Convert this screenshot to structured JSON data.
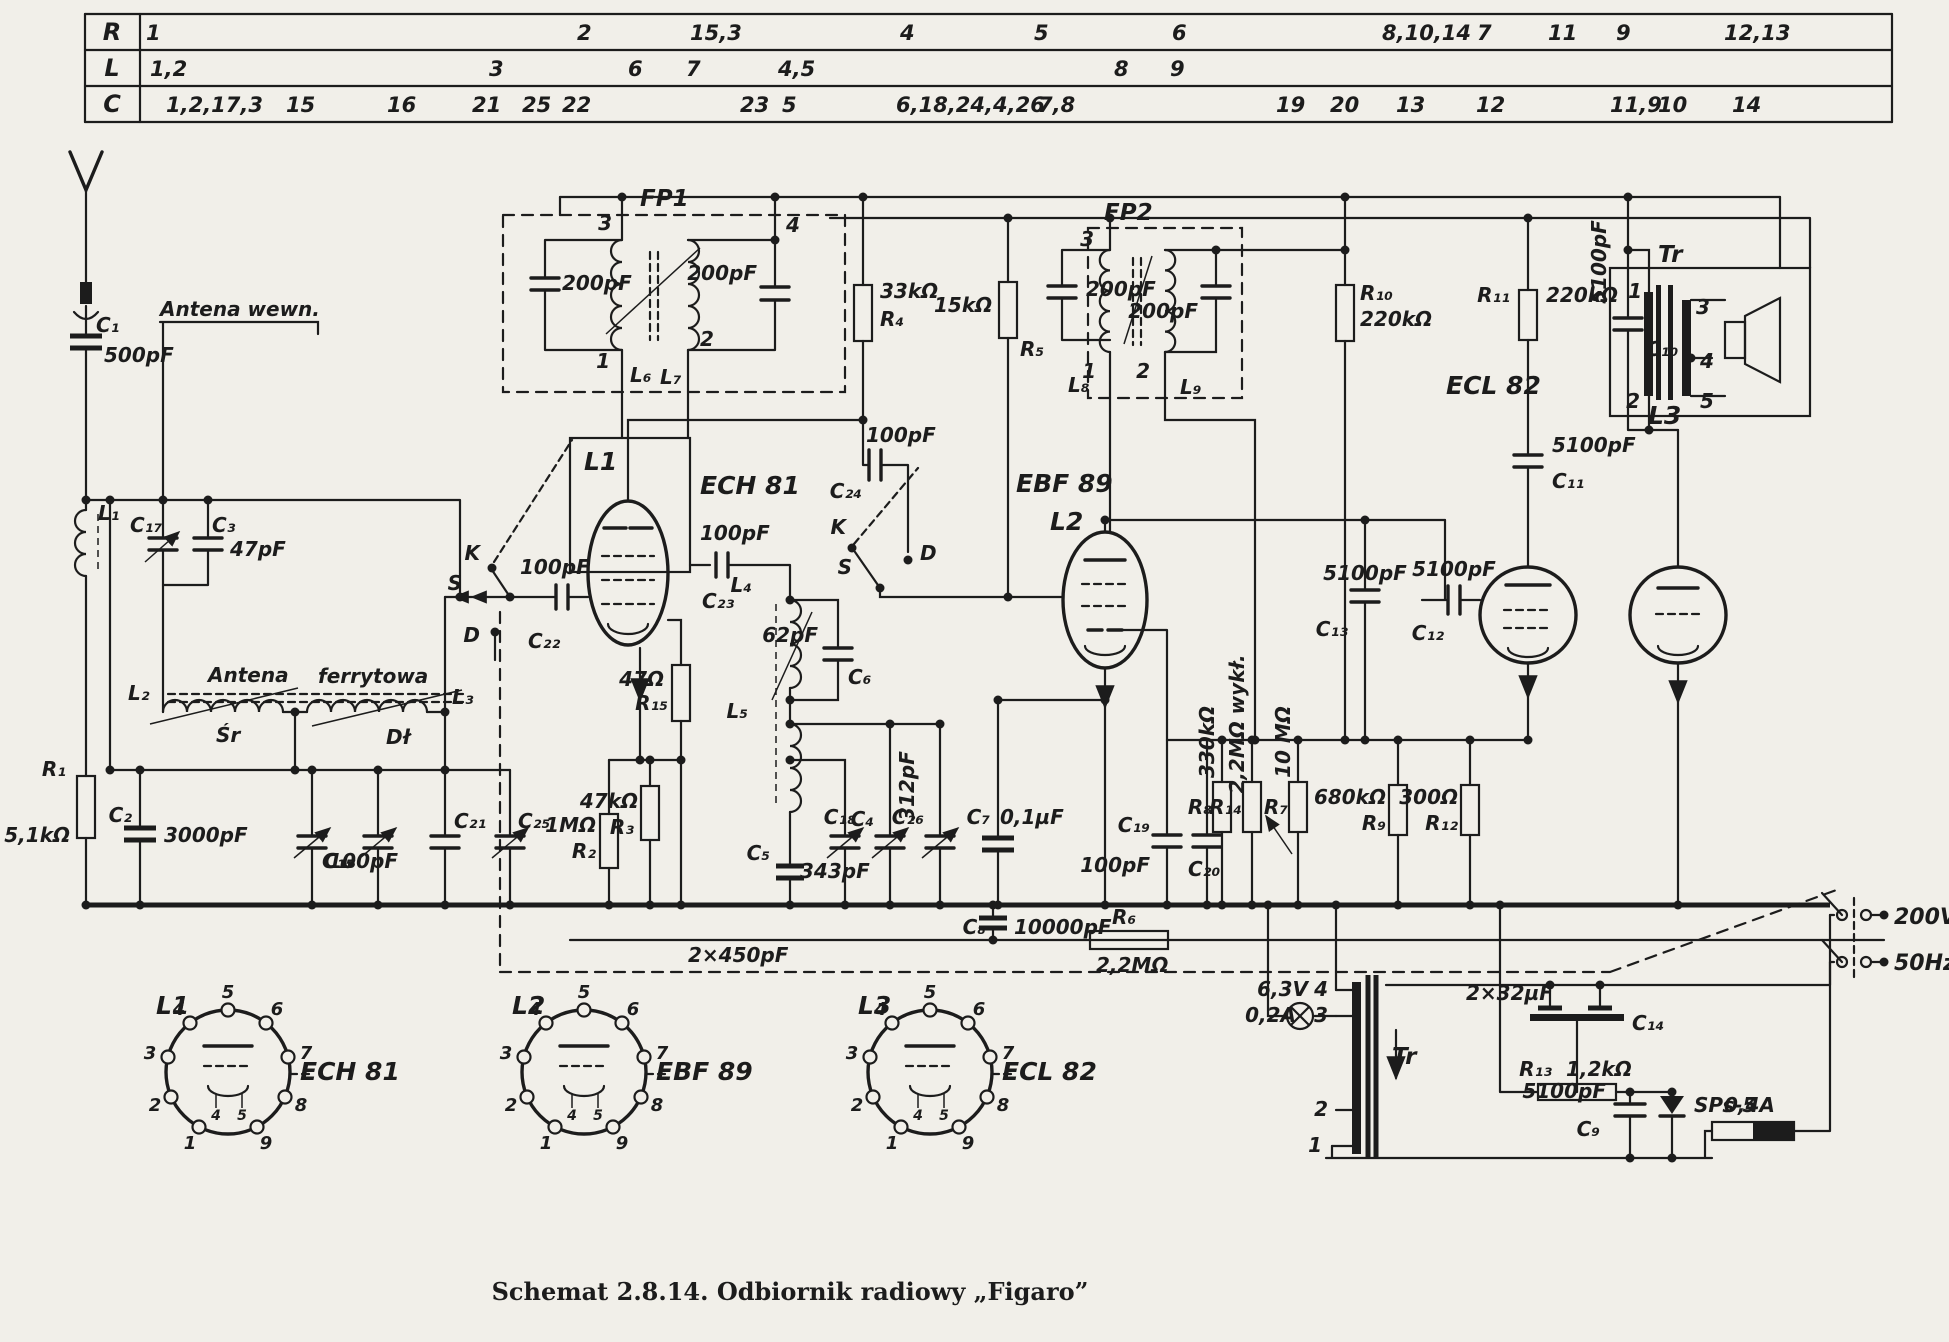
{
  "caption": "Schemat 2.8.14. Odbiornik radiowy „Figaro”",
  "colors": {
    "paper": "#f1efe9",
    "ink": "#1c1c1c"
  },
  "table": {
    "header_x": 112,
    "rows": [
      {
        "header": "R",
        "y": 40,
        "cells": [
          {
            "t": "1",
            "x": 146
          },
          {
            "t": "2",
            "x": 577
          },
          {
            "t": "15,3",
            "x": 690
          },
          {
            "t": "4",
            "x": 900
          },
          {
            "t": "5",
            "x": 1034
          },
          {
            "t": "6",
            "x": 1172
          },
          {
            "t": "8,10,14",
            "x": 1382
          },
          {
            "t": "7",
            "x": 1477
          },
          {
            "t": "11",
            "x": 1548
          },
          {
            "t": "9",
            "x": 1616
          },
          {
            "t": "12,13",
            "x": 1724
          }
        ]
      },
      {
        "header": "L",
        "y": 76,
        "cells": [
          {
            "t": "1,2",
            "x": 150
          },
          {
            "t": "3",
            "x": 489
          },
          {
            "t": "6",
            "x": 628
          },
          {
            "t": "7",
            "x": 686
          },
          {
            "t": "4,5",
            "x": 778
          },
          {
            "t": "8",
            "x": 1114
          },
          {
            "t": "9",
            "x": 1170
          }
        ]
      },
      {
        "header": "C",
        "y": 112,
        "cells": [
          {
            "t": "1,2,17,3",
            "x": 166
          },
          {
            "t": "15",
            "x": 286
          },
          {
            "t": "16",
            "x": 387
          },
          {
            "t": "21",
            "x": 472
          },
          {
            "t": "25",
            "x": 522
          },
          {
            "t": "22",
            "x": 562
          },
          {
            "t": "23",
            "x": 740
          },
          {
            "t": "5",
            "x": 782
          },
          {
            "t": "6,18,24,4,26",
            "x": 896
          },
          {
            "t": "7,8",
            "x": 1038
          },
          {
            "t": "19",
            "x": 1276
          },
          {
            "t": "20",
            "x": 1330
          },
          {
            "t": "13",
            "x": 1396
          },
          {
            "t": "12",
            "x": 1476
          },
          {
            "t": "11,9",
            "x": 1610
          },
          {
            "t": "10",
            "x": 1658
          },
          {
            "t": "14",
            "x": 1732
          }
        ]
      }
    ]
  },
  "schematic_labels": [
    {
      "t": "C₁",
      "x": 96,
      "y": 332
    },
    {
      "t": "500pF",
      "x": 104,
      "y": 362
    },
    {
      "t": "Antena wewn.",
      "x": 160,
      "y": 316
    },
    {
      "t": "L₁",
      "x": 98,
      "y": 520
    },
    {
      "t": "C₁₇",
      "x": 130,
      "y": 532
    },
    {
      "t": "C₃",
      "x": 212,
      "y": 532
    },
    {
      "t": "47pF",
      "x": 230,
      "y": 556
    },
    {
      "t": "L₂",
      "x": 128,
      "y": 700
    },
    {
      "t": "Antena",
      "x": 208,
      "y": 682
    },
    {
      "t": "ferrytowa",
      "x": 318,
      "y": 683
    },
    {
      "t": "Śr",
      "x": 216,
      "y": 742
    },
    {
      "t": "Dł",
      "x": 386,
      "y": 744
    },
    {
      "t": "L₃",
      "x": 452,
      "y": 704
    },
    {
      "t": "R₁",
      "x": 66,
      "y": 776,
      "a": "end"
    },
    {
      "t": "5,1kΩ",
      "x": 70,
      "y": 842,
      "a": "end"
    },
    {
      "t": "C₂",
      "x": 132,
      "y": 822,
      "a": "end"
    },
    {
      "t": "3000pF",
      "x": 164,
      "y": 842
    },
    {
      "t": "C₁₅",
      "x": 322,
      "y": 868
    },
    {
      "t": "C₁₆",
      "x": 356,
      "y": 868,
      "a": "end"
    },
    {
      "t": "C₂₁",
      "x": 454,
      "y": 828
    },
    {
      "t": "100pF",
      "x": 398,
      "y": 868,
      "a": "end"
    },
    {
      "t": "C₂₅",
      "x": 518,
      "y": 828
    },
    {
      "t": "K",
      "x": 480,
      "y": 560,
      "a": "end"
    },
    {
      "t": "S",
      "x": 462,
      "y": 590,
      "a": "end"
    },
    {
      "t": "D",
      "x": 480,
      "y": 642,
      "a": "end"
    },
    {
      "t": "100pF",
      "x": 520,
      "y": 574
    },
    {
      "t": "C₂₂",
      "x": 528,
      "y": 648
    },
    {
      "t": "FP1",
      "x": 640,
      "y": 206,
      "fs": 23
    },
    {
      "t": "3",
      "x": 612,
      "y": 230,
      "a": "end"
    },
    {
      "t": "200pF",
      "x": 562,
      "y": 290
    },
    {
      "t": "1",
      "x": 610,
      "y": 368,
      "a": "end"
    },
    {
      "t": "L₆",
      "x": 630,
      "y": 382
    },
    {
      "t": "4",
      "x": 786,
      "y": 232
    },
    {
      "t": "2",
      "x": 700,
      "y": 346
    },
    {
      "t": "L₇",
      "x": 660,
      "y": 384
    },
    {
      "t": "200pF",
      "x": 757,
      "y": 280,
      "a": "end"
    },
    {
      "t": "L1",
      "x": 584,
      "y": 470,
      "fs": 25
    },
    {
      "t": "ECH 81",
      "x": 700,
      "y": 494,
      "fs": 25
    },
    {
      "t": "100pF",
      "x": 700,
      "y": 540
    },
    {
      "t": "C₂₃",
      "x": 702,
      "y": 608
    },
    {
      "t": "L₄",
      "x": 752,
      "y": 592,
      "a": "end"
    },
    {
      "t": "62pF",
      "x": 818,
      "y": 642,
      "a": "end"
    },
    {
      "t": "C₆",
      "x": 848,
      "y": 684
    },
    {
      "t": "L₅",
      "x": 748,
      "y": 718,
      "a": "end"
    },
    {
      "t": "47Ω",
      "x": 664,
      "y": 686,
      "a": "end"
    },
    {
      "t": "R₁₅",
      "x": 668,
      "y": 710,
      "a": "end"
    },
    {
      "t": "1MΩ",
      "x": 596,
      "y": 832,
      "a": "end"
    },
    {
      "t": "R₂",
      "x": 596,
      "y": 858,
      "a": "end"
    },
    {
      "t": "47kΩ",
      "x": 638,
      "y": 808,
      "a": "end"
    },
    {
      "t": "R₃",
      "x": 634,
      "y": 834,
      "a": "end"
    },
    {
      "t": "C₅",
      "x": 770,
      "y": 860,
      "a": "end"
    },
    {
      "t": "343pF",
      "x": 800,
      "y": 878
    },
    {
      "t": "2×450pF",
      "x": 688,
      "y": 962
    },
    {
      "t": "C₈",
      "x": 986,
      "y": 934,
      "a": "end"
    },
    {
      "t": "10000pF",
      "x": 1014,
      "y": 934
    },
    {
      "t": "R₆",
      "x": 1112,
      "y": 924
    },
    {
      "t": "2,2MΩ",
      "x": 1096,
      "y": 972
    },
    {
      "t": "100pF",
      "x": 866,
      "y": 442
    },
    {
      "t": "C₂₄",
      "x": 862,
      "y": 498,
      "a": "end"
    },
    {
      "t": "K",
      "x": 846,
      "y": 534,
      "a": "end"
    },
    {
      "t": "S",
      "x": 852,
      "y": 574,
      "a": "end"
    },
    {
      "t": "D",
      "x": 920,
      "y": 560
    },
    {
      "t": "33kΩ",
      "x": 880,
      "y": 298
    },
    {
      "t": "R₄",
      "x": 880,
      "y": 326
    },
    {
      "t": "15kΩ",
      "x": 934,
      "y": 312
    },
    {
      "t": "R₅",
      "x": 1020,
      "y": 356
    },
    {
      "t": "FP2",
      "x": 1104,
      "y": 220,
      "fs": 23
    },
    {
      "t": "3",
      "x": 1094,
      "y": 246,
      "a": "end"
    },
    {
      "t": "200pF",
      "x": 1086,
      "y": 296
    },
    {
      "t": "1",
      "x": 1096,
      "y": 378,
      "a": "end"
    },
    {
      "t": "L₈",
      "x": 1068,
      "y": 392
    },
    {
      "t": "2",
      "x": 1150,
      "y": 378,
      "a": "end"
    },
    {
      "t": "L₉",
      "x": 1180,
      "y": 394
    },
    {
      "t": "200pF",
      "x": 1198,
      "y": 318,
      "a": "end"
    },
    {
      "t": "EBF 89",
      "x": 1016,
      "y": 492,
      "fs": 25
    },
    {
      "t": "L2",
      "x": 1050,
      "y": 530,
      "fs": 25
    },
    {
      "t": "R₁₀",
      "x": 1360,
      "y": 300
    },
    {
      "t": "220kΩ",
      "x": 1360,
      "y": 326
    },
    {
      "t": "R₁₁",
      "x": 1510,
      "y": 302,
      "a": "end"
    },
    {
      "t": "220kΩ",
      "x": 1546,
      "y": 302
    },
    {
      "t": "5100pF",
      "x": 1606,
      "y": 262,
      "rot": -90,
      "a": "middle"
    },
    {
      "t": "C₁₀",
      "x": 1646,
      "y": 356
    },
    {
      "t": "Tr",
      "x": 1658,
      "y": 262,
      "fs": 23
    },
    {
      "t": "1",
      "x": 1642,
      "y": 298,
      "a": "end"
    },
    {
      "t": "2",
      "x": 1640,
      "y": 408,
      "a": "end"
    },
    {
      "t": "3",
      "x": 1696,
      "y": 314
    },
    {
      "t": "4",
      "x": 1700,
      "y": 368
    },
    {
      "t": "5",
      "x": 1700,
      "y": 408
    },
    {
      "t": "5100pF",
      "x": 1552,
      "y": 452
    },
    {
      "t": "C₁₁",
      "x": 1552,
      "y": 488
    },
    {
      "t": "ECL 82",
      "x": 1446,
      "y": 394,
      "fs": 25
    },
    {
      "t": "L3",
      "x": 1648,
      "y": 424,
      "fs": 25
    },
    {
      "t": "5100pF",
      "x": 1365,
      "y": 580,
      "a": "middle"
    },
    {
      "t": "C₁₃",
      "x": 1348,
      "y": 636,
      "a": "end"
    },
    {
      "t": "5100pF",
      "x": 1454,
      "y": 576,
      "a": "middle"
    },
    {
      "t": "C₁₂",
      "x": 1444,
      "y": 640,
      "a": "end"
    },
    {
      "t": "330kΩ",
      "x": 1214,
      "y": 742,
      "rot": -90,
      "a": "middle"
    },
    {
      "t": "R₈",
      "x": 1212,
      "y": 814,
      "a": "end"
    },
    {
      "t": "2,2MΩ wykł.",
      "x": 1244,
      "y": 724,
      "rot": -90,
      "a": "middle"
    },
    {
      "t": "R₁₄",
      "x": 1242,
      "y": 814,
      "a": "end"
    },
    {
      "t": "10 MΩ",
      "x": 1290,
      "y": 742,
      "rot": -90,
      "a": "middle"
    },
    {
      "t": "R₇",
      "x": 1288,
      "y": 814,
      "a": "end"
    },
    {
      "t": "C₁₉",
      "x": 1150,
      "y": 832,
      "a": "end"
    },
    {
      "t": "100pF",
      "x": 1150,
      "y": 872,
      "a": "end"
    },
    {
      "t": "C₂₀",
      "x": 1188,
      "y": 876
    },
    {
      "t": "680kΩ",
      "x": 1386,
      "y": 804,
      "a": "end"
    },
    {
      "t": "R₉",
      "x": 1386,
      "y": 830,
      "a": "end"
    },
    {
      "t": "300Ω",
      "x": 1458,
      "y": 804,
      "a": "end"
    },
    {
      "t": "R₁₂",
      "x": 1458,
      "y": 830,
      "a": "end"
    },
    {
      "t": "C₁₈",
      "x": 856,
      "y": 824,
      "a": "end"
    },
    {
      "t": "C₄",
      "x": 874,
      "y": 826,
      "a": "end"
    },
    {
      "t": "312pF",
      "x": 914,
      "y": 786,
      "rot": -90,
      "a": "middle"
    },
    {
      "t": "C₂₆",
      "x": 924,
      "y": 824,
      "a": "end"
    },
    {
      "t": "C₇",
      "x": 990,
      "y": 824,
      "a": "end"
    },
    {
      "t": "0,1µF",
      "x": 1000,
      "y": 824
    },
    {
      "t": "6,3V",
      "x": 1308,
      "y": 996,
      "a": "end"
    },
    {
      "t": "0,2A",
      "x": 1296,
      "y": 1022,
      "a": "end"
    },
    {
      "t": "2×32µF",
      "x": 1466,
      "y": 1000
    },
    {
      "t": "C₁₄",
      "x": 1632,
      "y": 1030
    },
    {
      "t": "R₁₃",
      "x": 1552,
      "y": 1076,
      "a": "end"
    },
    {
      "t": "1,2kΩ",
      "x": 1566,
      "y": 1076
    },
    {
      "t": "SPs-5",
      "x": 1694,
      "y": 1112
    },
    {
      "t": "5100pF",
      "x": 1606,
      "y": 1098,
      "a": "end"
    },
    {
      "t": "C₉",
      "x": 1600,
      "y": 1136,
      "a": "end"
    },
    {
      "t": "Tr",
      "x": 1392,
      "y": 1064,
      "fs": 23
    },
    {
      "t": "4",
      "x": 1328,
      "y": 996,
      "a": "end"
    },
    {
      "t": "3",
      "x": 1328,
      "y": 1022,
      "a": "end"
    },
    {
      "t": "2",
      "x": 1328,
      "y": 1116,
      "a": "end"
    },
    {
      "t": "1",
      "x": 1322,
      "y": 1152,
      "a": "end"
    },
    {
      "t": "0,4A",
      "x": 1724,
      "y": 1112
    },
    {
      "t": "200V",
      "x": 1894,
      "y": 924,
      "fs": 22
    },
    {
      "t": "50Hz",
      "x": 1894,
      "y": 970,
      "fs": 22
    },
    {
      "t": "L1",
      "x": 156,
      "y": 1014,
      "fs": 25
    },
    {
      "t": "ECH 81",
      "x": 300,
      "y": 1080,
      "fs": 25
    },
    {
      "t": "L2",
      "x": 512,
      "y": 1014,
      "fs": 25
    },
    {
      "t": "EBF 89",
      "x": 656,
      "y": 1080,
      "fs": 25
    },
    {
      "t": "L3",
      "x": 858,
      "y": 1014,
      "fs": 25
    },
    {
      "t": "ECL 82",
      "x": 1002,
      "y": 1080,
      "fs": 25
    },
    {
      "t": "5",
      "x": 228,
      "y": 998,
      "fs": 18,
      "a": "middle"
    },
    {
      "t": "6",
      "x": 277,
      "y": 1015,
      "fs": 18,
      "a": "middle"
    },
    {
      "t": "7",
      "x": 306,
      "y": 1059,
      "fs": 18,
      "a": "middle"
    },
    {
      "t": "8",
      "x": 301,
      "y": 1111,
      "fs": 18,
      "a": "middle"
    },
    {
      "t": "9",
      "x": 266,
      "y": 1149,
      "fs": 18,
      "a": "middle"
    },
    {
      "t": "1",
      "x": 190,
      "y": 1149,
      "fs": 18,
      "a": "middle"
    },
    {
      "t": "2",
      "x": 155,
      "y": 1111,
      "fs": 18,
      "a": "middle"
    },
    {
      "t": "3",
      "x": 150,
      "y": 1059,
      "fs": 18,
      "a": "middle"
    },
    {
      "t": "4",
      "x": 179,
      "y": 1015,
      "fs": 18,
      "a": "middle"
    },
    {
      "t": "5",
      "x": 584,
      "y": 998,
      "fs": 18,
      "a": "middle"
    },
    {
      "t": "6",
      "x": 633,
      "y": 1015,
      "fs": 18,
      "a": "middle"
    },
    {
      "t": "7",
      "x": 662,
      "y": 1059,
      "fs": 18,
      "a": "middle"
    },
    {
      "t": "8",
      "x": 657,
      "y": 1111,
      "fs": 18,
      "a": "middle"
    },
    {
      "t": "9",
      "x": 622,
      "y": 1149,
      "fs": 18,
      "a": "middle"
    },
    {
      "t": "1",
      "x": 546,
      "y": 1149,
      "fs": 18,
      "a": "middle"
    },
    {
      "t": "2",
      "x": 511,
      "y": 1111,
      "fs": 18,
      "a": "middle"
    },
    {
      "t": "3",
      "x": 506,
      "y": 1059,
      "fs": 18,
      "a": "middle"
    },
    {
      "t": "4",
      "x": 535,
      "y": 1015,
      "fs": 18,
      "a": "middle"
    },
    {
      "t": "5",
      "x": 930,
      "y": 998,
      "fs": 18,
      "a": "middle"
    },
    {
      "t": "6",
      "x": 979,
      "y": 1015,
      "fs": 18,
      "a": "middle"
    },
    {
      "t": "7",
      "x": 1008,
      "y": 1059,
      "fs": 18,
      "a": "middle"
    },
    {
      "t": "8",
      "x": 1003,
      "y": 1111,
      "fs": 18,
      "a": "middle"
    },
    {
      "t": "9",
      "x": 968,
      "y": 1149,
      "fs": 18,
      "a": "middle"
    },
    {
      "t": "1",
      "x": 892,
      "y": 1149,
      "fs": 18,
      "a": "middle"
    },
    {
      "t": "2",
      "x": 857,
      "y": 1111,
      "fs": 18,
      "a": "middle"
    },
    {
      "t": "3",
      "x": 852,
      "y": 1059,
      "fs": 18,
      "a": "middle"
    },
    {
      "t": "4",
      "x": 881,
      "y": 1015,
      "fs": 18,
      "a": "middle"
    },
    {
      "t": "4",
      "x": 216,
      "y": 1120,
      "fs": 14,
      "a": "middle"
    },
    {
      "t": "5",
      "x": 242,
      "y": 1120,
      "fs": 14,
      "a": "middle"
    },
    {
      "t": "4",
      "x": 572,
      "y": 1120,
      "fs": 14,
      "a": "middle"
    },
    {
      "t": "5",
      "x": 598,
      "y": 1120,
      "fs": 14,
      "a": "middle"
    },
    {
      "t": "4",
      "x": 918,
      "y": 1120,
      "fs": 14,
      "a": "middle"
    },
    {
      "t": "5",
      "x": 944,
      "y": 1120,
      "fs": 14,
      "a": "middle"
    }
  ]
}
